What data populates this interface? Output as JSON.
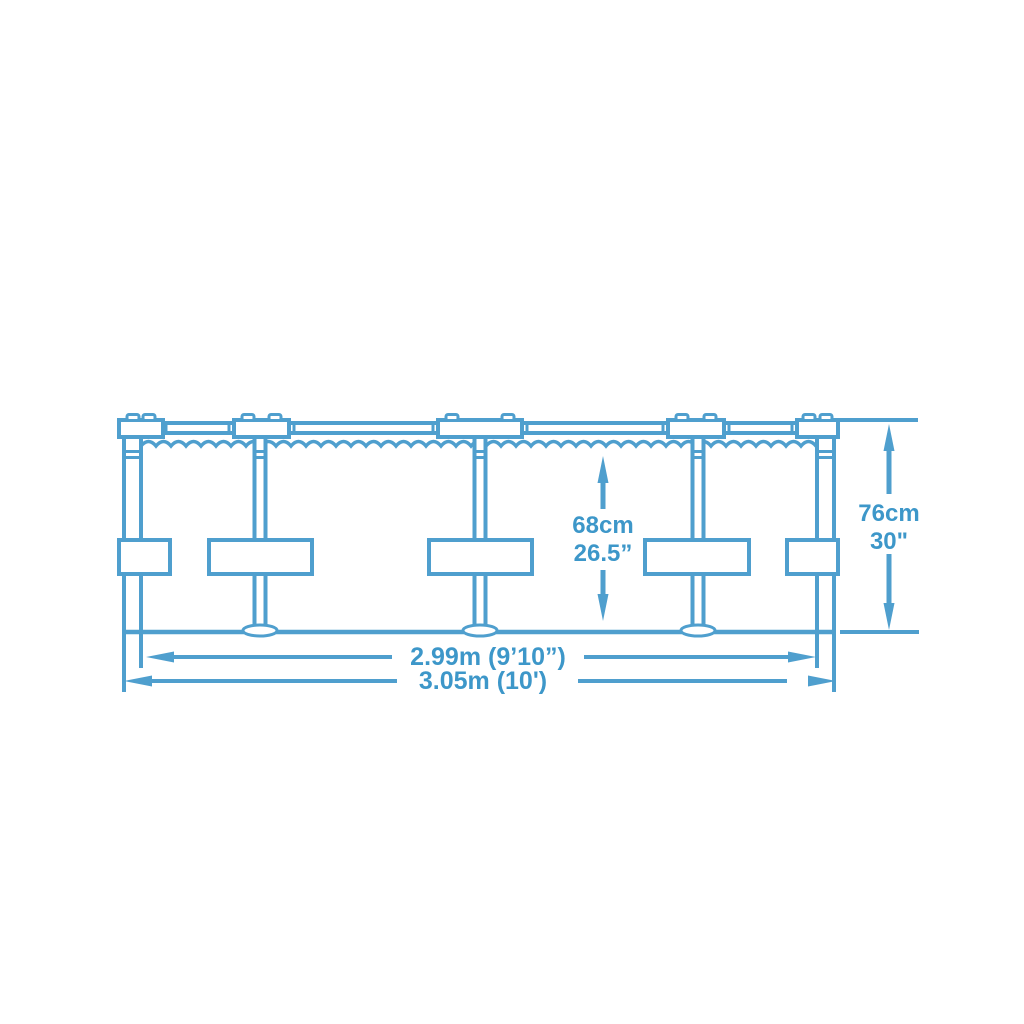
{
  "page": {
    "background": "#ffffff"
  },
  "diagram": {
    "kind": "above-ground-frame-pool-side-view-dimension-drawing",
    "line_color": "#4F9FCE",
    "text_color": "#3D97C9",
    "labels": {
      "water_height_metric": "68cm",
      "water_height_imperial": "26.5”",
      "total_height_metric": "76cm",
      "total_height_imperial": "30\"",
      "inner_diameter": "2.99m (9’10”)",
      "outer_diameter": "3.05m (10')"
    }
  }
}
